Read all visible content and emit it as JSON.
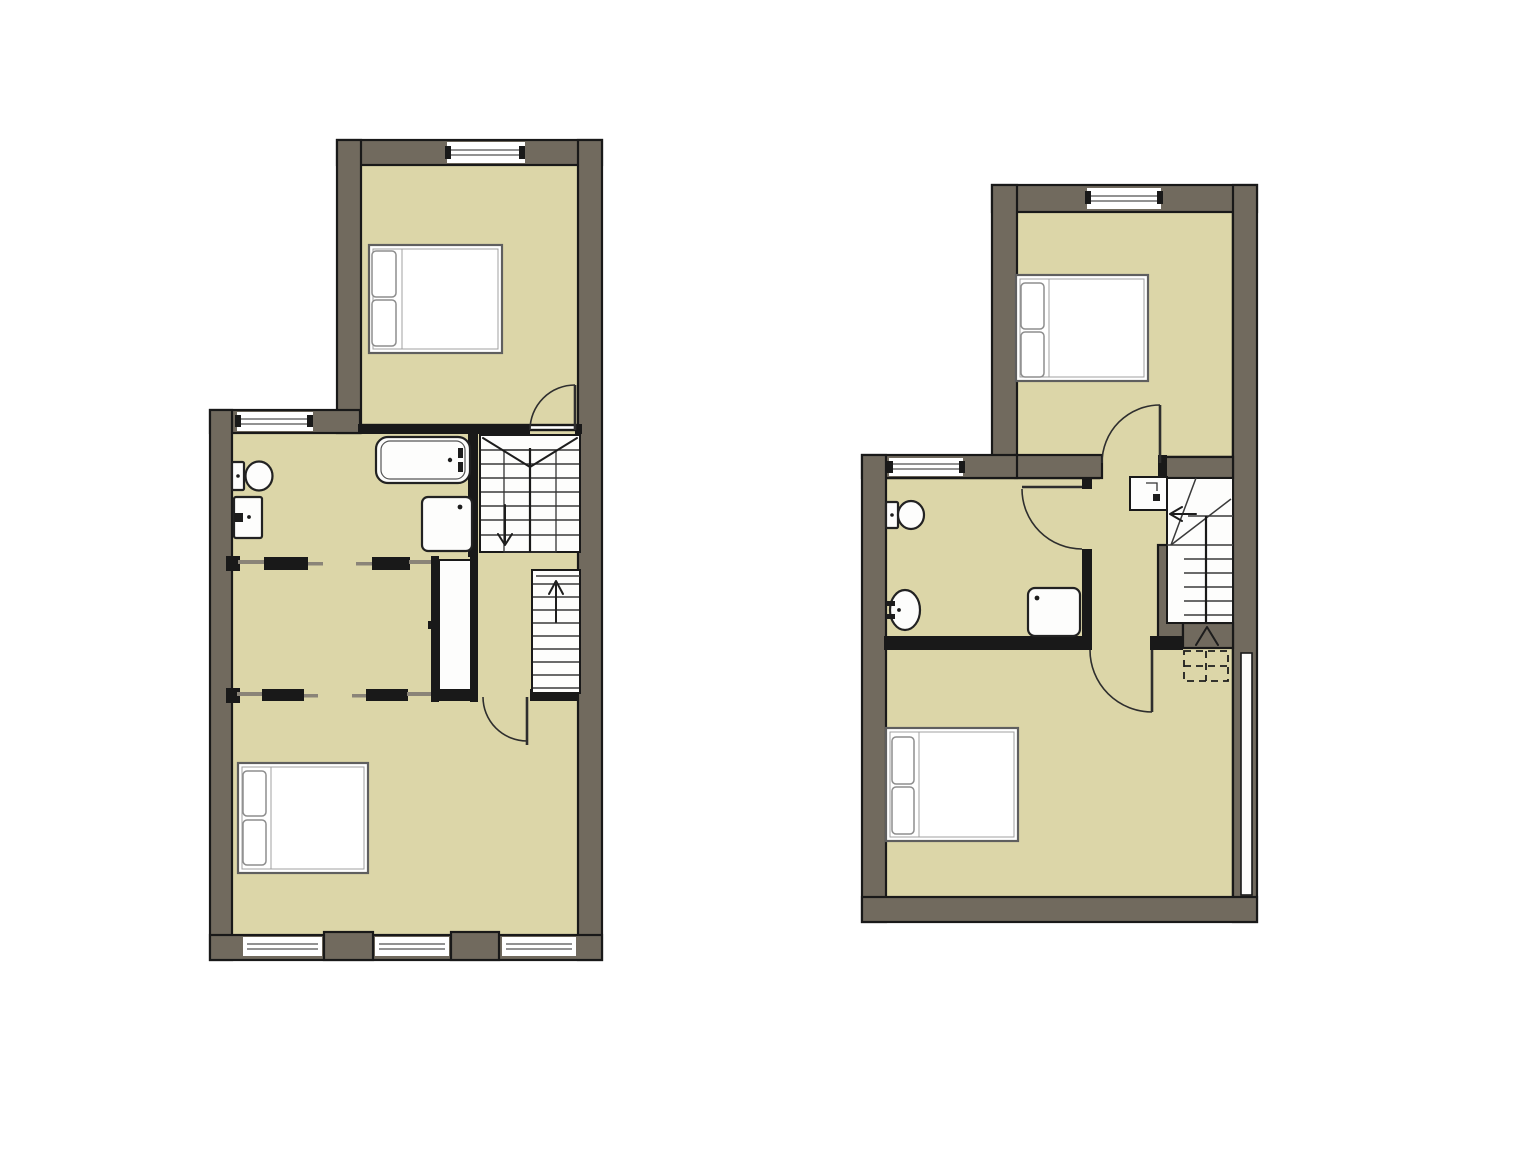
{
  "palette": {
    "page_bg": "#ffffff",
    "wall": "#716a5e",
    "outline": "#191919",
    "floor": "#dcd6a8",
    "rail": "#8a8478",
    "stair_line": "#3a3a3a",
    "door_line": "#2e2e2e",
    "bed_stroke": "#5f5f5f",
    "pillow_stroke": "#8d8d8d",
    "fixture_fill": "#fdfdfc"
  },
  "drawing": {
    "type": "architectural-floor-plan",
    "text_labels": [],
    "plans": [
      {
        "id": "floor-plan-left",
        "position": "left",
        "rooms": [
          {
            "name": "bedroom-top",
            "fixtures": [
              "double-bed"
            ],
            "windows": 1,
            "doors": [
              "hinged-door"
            ]
          },
          {
            "name": "bathroom",
            "fixtures": [
              "toilet",
              "washbasin",
              "bathtub",
              "shower-tray"
            ],
            "windows": 1
          },
          {
            "name": "inner-room",
            "features": [
              "sliding-doors",
              "built-in-closet"
            ]
          },
          {
            "name": "stair-hall",
            "features": [
              "staircase-double-flight",
              "staircase-single-flight",
              "down-arrow",
              "up-arrow"
            ]
          },
          {
            "name": "bedroom-bottom",
            "fixtures": [
              "double-bed"
            ],
            "windows": 3,
            "doors": [
              "hinged-door"
            ]
          }
        ]
      },
      {
        "id": "floor-plan-right",
        "position": "right",
        "rooms": [
          {
            "name": "bedroom-top",
            "fixtures": [
              "double-bed"
            ],
            "windows": 1,
            "doors": [
              "hinged-door"
            ]
          },
          {
            "name": "bathroom",
            "fixtures": [
              "toilet",
              "washbasin",
              "shower-tray"
            ],
            "windows": 1,
            "doors": [
              "hinged-door"
            ]
          },
          {
            "name": "hallway",
            "features": [
              "cupboard"
            ]
          },
          {
            "name": "staircase",
            "features": [
              "winder-stairs",
              "straight-flight",
              "left-arrow",
              "up-arrow",
              "dashed-flight-below"
            ]
          },
          {
            "name": "bedroom-bottom",
            "fixtures": [
              "double-bed"
            ],
            "doors": [
              "hinged-door"
            ],
            "features": [
              "wall-recess-strip"
            ]
          }
        ]
      }
    ]
  }
}
